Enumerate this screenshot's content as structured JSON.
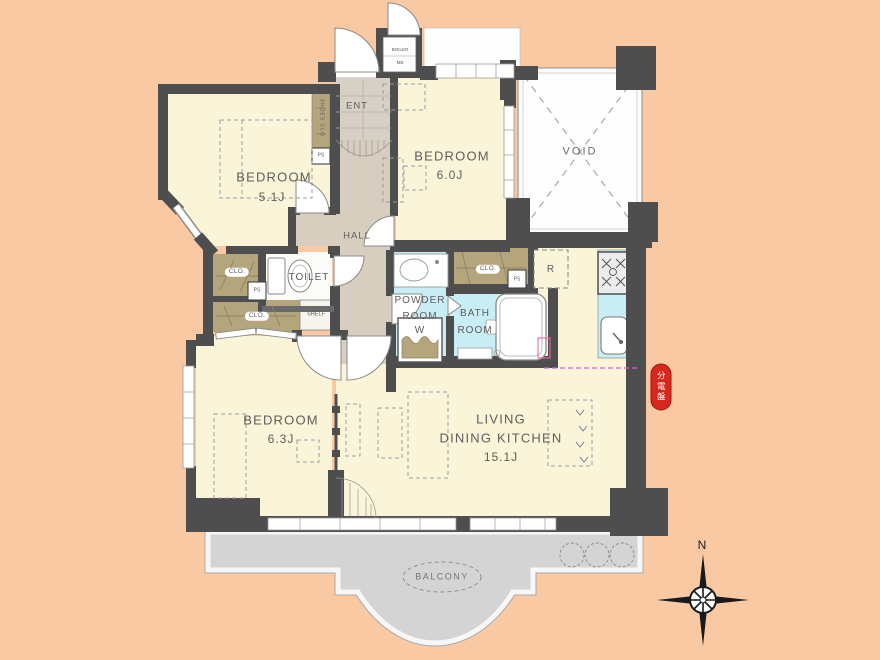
{
  "plan": {
    "rooms": {
      "bedroom_a": {
        "name": "BEDROOM",
        "size": "5.1J"
      },
      "bedroom_b": {
        "name": "BEDROOM",
        "size": "6.0J"
      },
      "bedroom_c": {
        "name": "BEDROOM",
        "size": "6.3J"
      },
      "ldk": {
        "line1": "LIVING",
        "line2": "DINING KITCHEN",
        "size": "15.1J"
      },
      "void_label": "VOID",
      "hall_label": "HALL",
      "entrance_label": "ENT",
      "toilet_label": "TOILET",
      "powder_room": {
        "line1": "POWDER",
        "line2": "ROOM"
      },
      "bath_room": {
        "line1": "BATH",
        "line2": "ROOM"
      },
      "balcony_label": "BALCONY"
    },
    "fixtures": {
      "shoes_closet": "SHOES CLO.",
      "boiler": "BOILER",
      "meter_box": "MB",
      "closet": "CLO.",
      "pipe_space": "PS",
      "shelf": "SHELF",
      "washing_machine": "W",
      "refrigerator": "R"
    },
    "annotations": {
      "distribution_board": "分電盤",
      "compass_north": "N"
    },
    "colors": {
      "background": "#f9c9a3",
      "room_floor": "#faf5d8",
      "hall_floor": "#d8cec0",
      "wet_area": "#c9edf4",
      "closet_fill": "#b5a57c",
      "wall": "#4e4e4e",
      "balcony": "#d4d4d4",
      "distribution_board_red": "#d8271c"
    }
  }
}
